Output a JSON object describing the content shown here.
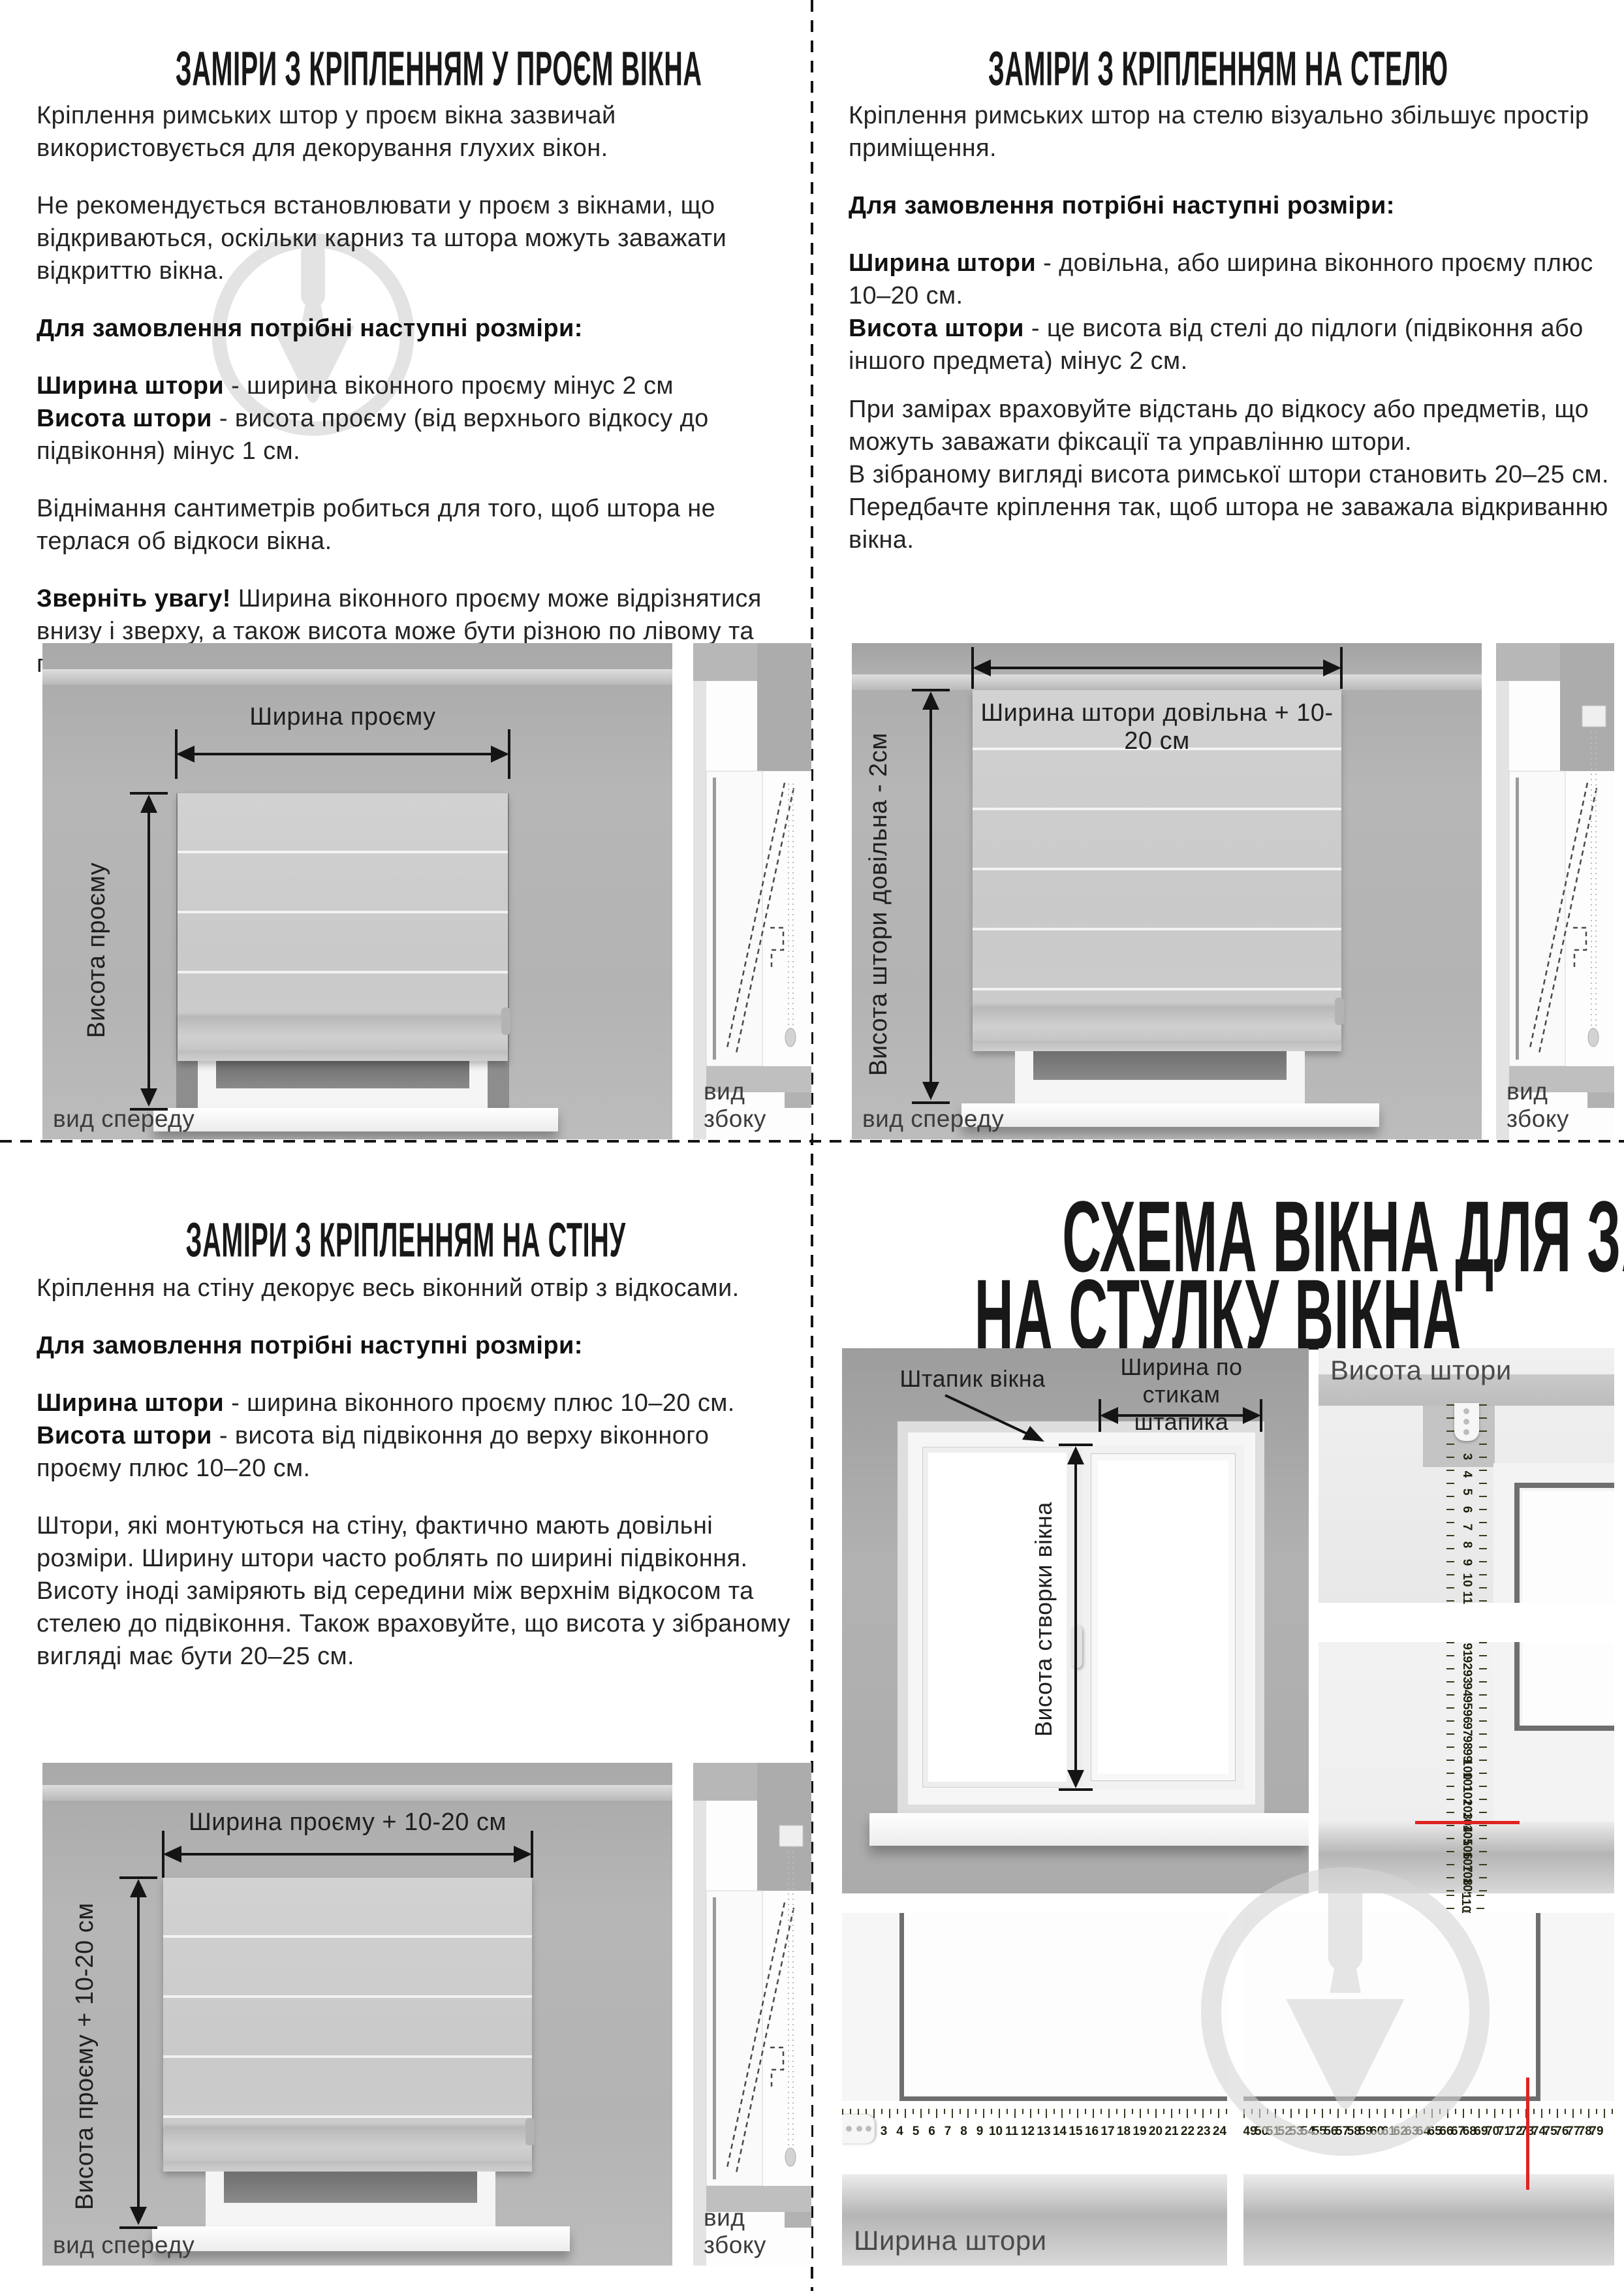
{
  "colors": {
    "tape_yellow": "#e9da3c",
    "red_mark": "#e02222",
    "watermark_gray": "#cfcfcf",
    "divider": "#141414"
  },
  "top_left": {
    "title": "ЗАМІРИ З КРІПЛЕННЯМ У ПРОЄМ ВІКНА",
    "p1": "Кріплення римських штор у проєм вікна зазвичай використовується для декорування глухих вікон.",
    "p2": "Не рекомендується встановлювати у проєм з вікнами, що відкриваються, оскільки карниз та штора можуть заважати відкриттю вікна.",
    "order_lead": "Для замовлення потрібні наступні розміри:",
    "width_term": "Ширина штори",
    "width_rest": " - ширина віконного проєму мінус 2 см",
    "height_term": "Висота штори",
    "height_rest": " - висота проєму (від верхнього відкосу до підвіконня) мінус 1 см.",
    "p3": "Віднімання сантиметрів робиться для того, щоб штора не терлася об відкоси вікна.",
    "note_term": "Зверніть увагу!",
    "note_rest": " Ширина віконного проєму може відрізнятися внизу і зверху, а також висота може бути різною по лівому та правому краях проєму.",
    "diagram": {
      "width_arrow": "Ширина проєму",
      "height_arrow": "Висота проєму",
      "front": "вид спереду",
      "side": "вид збоку"
    }
  },
  "top_right": {
    "title": "ЗАМІРИ З КРІПЛЕННЯМ НА СТЕЛЮ",
    "p1": "Кріплення римських штор на стелю візуально збільшує простір приміщення.",
    "order_lead": "Для замовлення потрібні наступні розміри:",
    "width_term": "Ширина штори",
    "width_rest": " - довільна, або ширина віконного проєму плюс 10–20 см.",
    "height_term": "Висота штори",
    "height_rest": " - це висота від стелі до підлоги (підвіконня або іншого предмета) мінус 2 см.",
    "p2": "При замірах враховуйте відстань до відкосу або предметів, що можуть заважати фіксації та управлінню штори.",
    "p3": "В зібраному вигляді висота римської штори становить 20–25 см. Передбачте кріплення так, щоб штора не заважала відкриванню вікна.",
    "diagram": {
      "width_arrow": "Ширина штори довільна + 10-20 см",
      "height_arrow": "Висота штори довільна - 2см",
      "front": "вид спереду",
      "side": "вид збоку"
    }
  },
  "bottom_left": {
    "title": "ЗАМІРИ З КРІПЛЕННЯМ НА СТІНУ",
    "p1": "Кріплення на стіну декорує весь віконний отвір з відкосами.",
    "order_lead": "Для замовлення потрібні наступні розміри:",
    "width_term": "Ширина штори",
    "width_rest": " - ширина віконного проєму плюс 10–20 см.",
    "height_term": "Висота штори",
    "height_rest": " - висота від підвіконня до верху віконного проєму плюс 10–20 см.",
    "p2": "Штори, які монтуються на стіну, фактично мають довільні розміри. Ширину штори часто роблять по ширині підвіконня. Висоту іноді заміряють від середини між верхнім відкосом та стелею до підвіконня. Також враховуйте, що висота у зібраному вигляді має бути 20–25 см.",
    "diagram": {
      "width_arrow": "Ширина проєму + 10-20 см",
      "height_arrow": "Висота проєму + 10-20 см",
      "front": "вид спереду",
      "side": "вид збоку"
    }
  },
  "bottom_right": {
    "title_line1": "СХЕМА ВІКНА ДЛЯ ЗАМІРІВ",
    "title_line2": "НА СТУЛКУ ВІКНА",
    "window_labels": {
      "bead": "Штапик вікна",
      "width_joints_line1": "Ширина по стикам",
      "width_joints_line2": "штапика",
      "sash_height": "Висота створки вікна"
    },
    "height_panel_label": "Висота штори",
    "width_panel_label": "Ширина штори",
    "tapes": {
      "vertical_top": {
        "start": 3,
        "end": 11
      },
      "vertical_bottom": {
        "start": 91,
        "end": 109
      },
      "vertical_stub": {
        "start": 110,
        "end": 111
      },
      "vertical_red_at": 104,
      "horizontal_left": {
        "start": 3,
        "end": 24
      },
      "horizontal_right": {
        "start": 49,
        "end": 79
      },
      "horizontal_red_at": 73
    }
  }
}
